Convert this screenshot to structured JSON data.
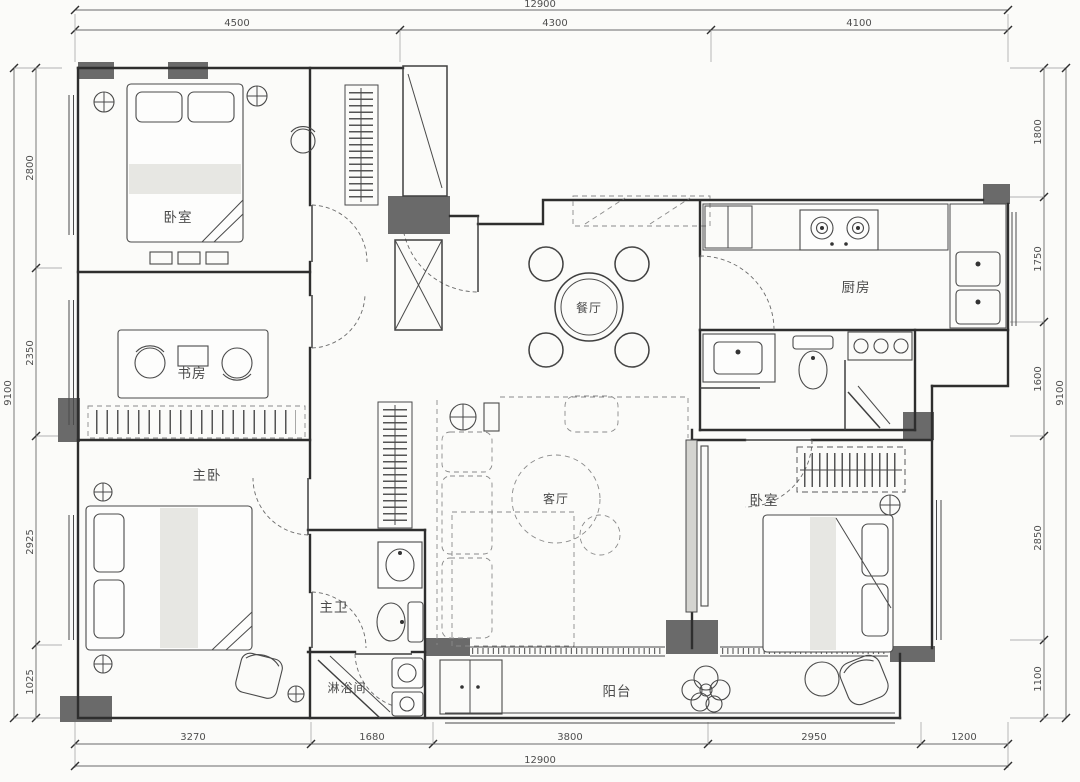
{
  "drawing": {
    "type": "apartment-floor-plan",
    "units": "mm"
  },
  "rooms": {
    "bedroom1": {
      "label": "卧室"
    },
    "study": {
      "label": "书房"
    },
    "master_bedroom": {
      "label": "主卧"
    },
    "dining": {
      "label": "餐厅"
    },
    "kitchen": {
      "label": "厨房"
    },
    "living": {
      "label": "客厅"
    },
    "bedroom2": {
      "label": "卧室"
    },
    "master_bath": {
      "label": "主卫"
    },
    "shower_room": {
      "label": "淋浴间"
    },
    "balcony": {
      "label": "阳台"
    }
  },
  "dimensions": {
    "top": {
      "total": "12900",
      "segments": [
        "4500",
        "4300",
        "4100"
      ]
    },
    "bottom": {
      "total": "12900",
      "segments": [
        "3270",
        "1680",
        "3800",
        "2950",
        "1200"
      ]
    },
    "left": {
      "total": "9100",
      "segments": [
        "2800",
        "2350",
        "2925",
        "1025"
      ]
    },
    "right": {
      "total": "9100",
      "segments": [
        "1800",
        "1750",
        "1600",
        "2850",
        "1100"
      ]
    }
  },
  "colors": {
    "background": "#fbfbf9",
    "wall_line": "#2e2e2e",
    "structural_fill": "#6a6a6a",
    "dim_text": "#4f4f4f"
  }
}
